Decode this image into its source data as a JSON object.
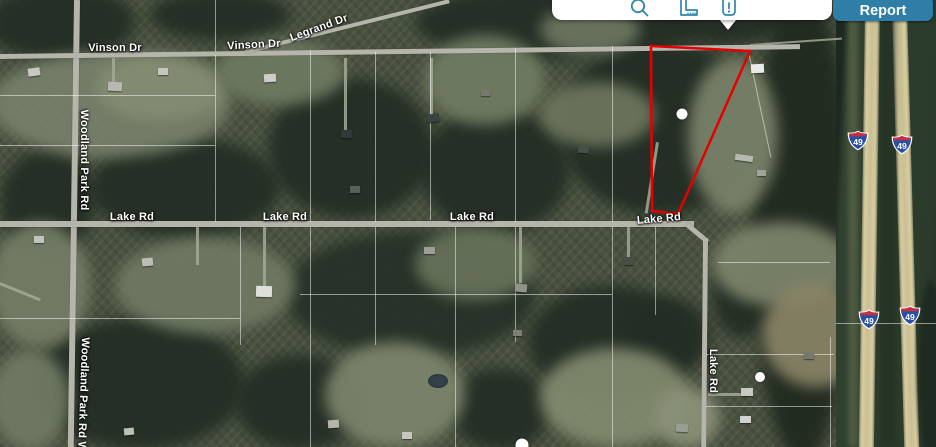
{
  "toolbar": {
    "background": "#ffffff",
    "icon_color": "#2e86ab",
    "icons": [
      {
        "name": "search-icon",
        "meaning": "search"
      },
      {
        "name": "ruler-icon",
        "meaning": "measure"
      },
      {
        "name": "info-card-icon",
        "meaning": "parcel info",
        "active": true
      }
    ],
    "report_button": {
      "label": "Report",
      "background": "#2e7ea8",
      "text_color": "#ffffff"
    }
  },
  "map": {
    "type": "satellite",
    "road_labels": [
      {
        "text": "Vinson Dr",
        "x": 115,
        "y": 48,
        "rot": 0
      },
      {
        "text": "Vinson Dr",
        "x": 254,
        "y": 45,
        "rot": -3
      },
      {
        "text": "Legrand Dr",
        "x": 319,
        "y": 28,
        "rot": -20
      },
      {
        "text": "Lake Rd",
        "x": 132,
        "y": 217,
        "rot": 0
      },
      {
        "text": "Lake Rd",
        "x": 285,
        "y": 217,
        "rot": 0
      },
      {
        "text": "Lake Rd",
        "x": 472,
        "y": 217,
        "rot": 0
      },
      {
        "text": "Lake Rd",
        "x": 659,
        "y": 219,
        "rot": -5
      },
      {
        "text": "Woodland Park Rd",
        "x": 84,
        "y": 160,
        "rot": 90
      },
      {
        "text": "Woodland Park Rd Wo",
        "x": 83,
        "y": 398,
        "rot": 92
      },
      {
        "text": "Lake Rd",
        "x": 713,
        "y": 371,
        "rot": 90
      }
    ],
    "parcel_outline": {
      "color": "#e60000",
      "points": [
        [
          651,
          46
        ],
        [
          750,
          51
        ],
        [
          678,
          214
        ],
        [
          652,
          211
        ]
      ]
    },
    "markers": [
      {
        "x": 682,
        "y": 114,
        "size": 11
      },
      {
        "x": 760,
        "y": 377,
        "size": 10
      },
      {
        "x": 522,
        "y": 445,
        "size": 13
      }
    ],
    "highway_shields": [
      {
        "label": "49",
        "x": 858,
        "y": 143
      },
      {
        "label": "49",
        "x": 902,
        "y": 147
      },
      {
        "label": "49",
        "x": 869,
        "y": 322
      },
      {
        "label": "49",
        "x": 910,
        "y": 318
      }
    ],
    "shield_colors": {
      "body": "#2950a3",
      "band": "#c6303e",
      "text": "#ffffff"
    }
  }
}
